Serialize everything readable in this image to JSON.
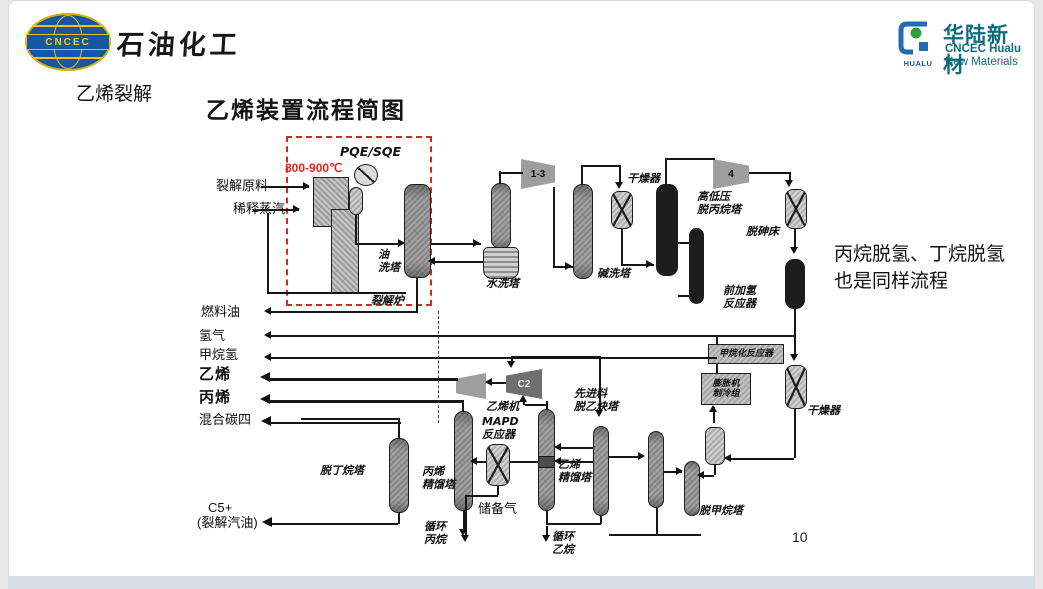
{
  "header": {
    "cncec_logo": "CNCEC",
    "cncec_title": "石油化工",
    "hualu_logo": "HUALU",
    "hualu_cn": "华陆新材",
    "hualu_en1": "CNCEC Hualu",
    "hualu_en2": "New Materials"
  },
  "slide": {
    "section": "乙烯裂解",
    "title": "乙烯装置流程简图",
    "note": "丙烷脱氢、丁烷脱氢\n也是同样流程",
    "page": "10"
  },
  "diagram": {
    "temperature": "800-900℃",
    "exchanger": "PQE/SQE",
    "inlets": {
      "feed": "裂解原料",
      "steam": "稀释蒸汽"
    },
    "products": {
      "fuel_oil": "燃料油",
      "hydrogen": "氢气",
      "methane_h2": "甲烷氢",
      "ethylene": "乙烯",
      "propylene": "丙烯",
      "mixed_c4": "混合碳四",
      "c5": "C5+",
      "c5_sub": "(裂解汽油)"
    },
    "equipment": {
      "furnace": "裂解炉",
      "oil_wash": "油\n洗塔",
      "water_wash": "水洗塔",
      "compressor_1_3": "1-3",
      "caustic_wash": "碱洗塔",
      "dryer1": "干燥器",
      "depropanizer": "高低压\n脱丙烷塔",
      "compressor_4": "4",
      "dearsenic_bed": "脱砷床",
      "front_hydrogenation": "前加氢\n反应器",
      "methanation": "甲烷化反应器",
      "expander_unit": "膨胀机\n制冷组",
      "dryer2": "干燥器",
      "demethanizer": "脱甲烷塔",
      "deacetylene": "先进料\n脱乙炔塔",
      "ethylene_tower": "乙烯\n精馏塔",
      "recycle_ethane": "循环\n乙烷",
      "compressor_c2": "C2",
      "ethylene_compressor": "乙烯机",
      "mapd": "MAPD\n反应器",
      "propylene_tower": "丙烯\n精馏塔",
      "recycle_propane": "循环\n丙烷",
      "storage_gas": "储备气",
      "debutanizer": "脱丁烷塔"
    }
  },
  "colors": {
    "accent_red": "#e02419",
    "hualu_teal": "#0c6c7c",
    "cncec_blue": "#1656a6",
    "logo_yellow": "#f2c200",
    "logo_green": "#2fa23c"
  }
}
